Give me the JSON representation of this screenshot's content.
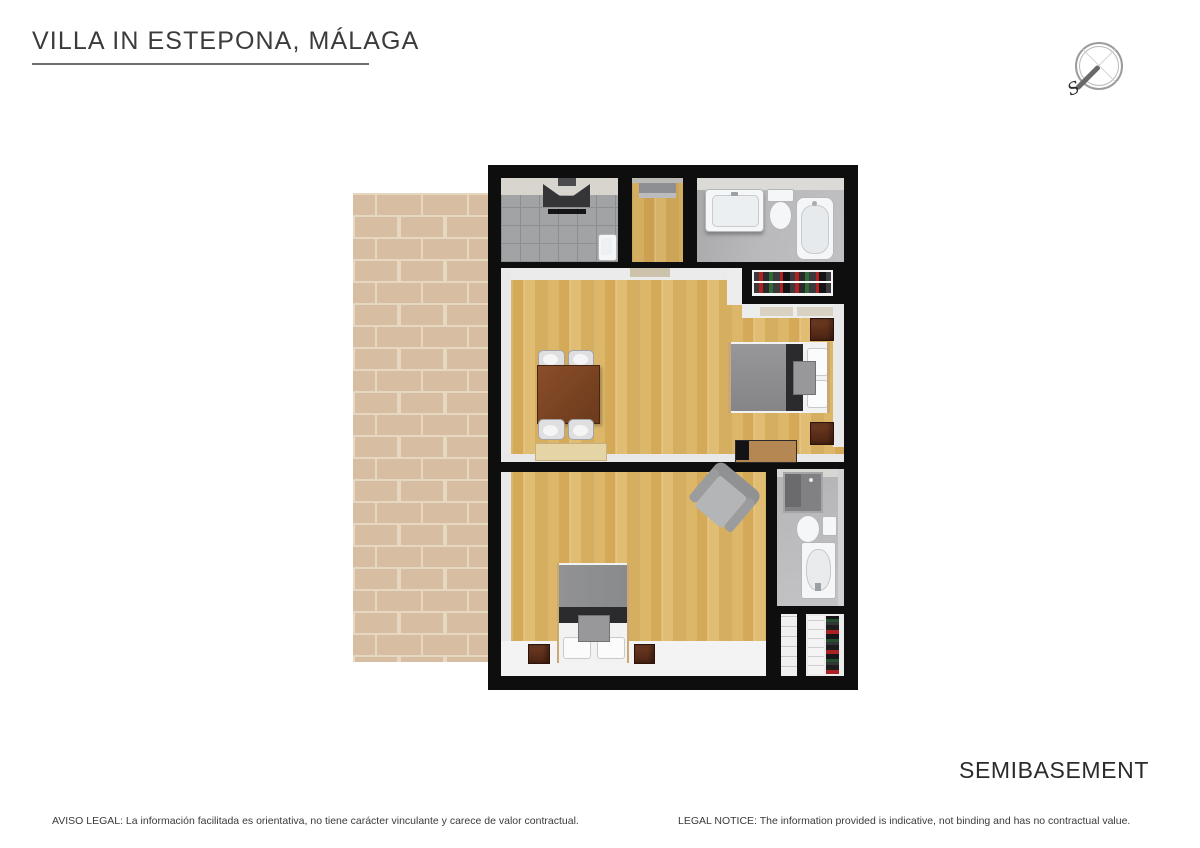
{
  "header": {
    "title": "VILLA IN ESTEPONA, MÁLAGA"
  },
  "compass": {
    "south_label": "S"
  },
  "floor_label": "SEMIBASEMENT",
  "footer": {
    "legal_es": "AVISO LEGAL: La información facilitada es orientativa, no tiene carácter vinculante y carece de valor contractual.",
    "legal_en": "LEGAL NOTICE: The information provided is indicative, not binding and has no contractual value."
  },
  "plan": {
    "rooms": [
      "terrace",
      "utility-room",
      "hallway",
      "bathroom",
      "wardrobe",
      "living-dining-room",
      "bedroom-1",
      "bedroom-2",
      "en-suite-bathroom",
      "closet"
    ],
    "palette": {
      "wall": "#0e0e0f",
      "wood_floor": "#d8b265",
      "terrace_brick": "#d9c0a6",
      "brick_mortar": "#eaddc9",
      "tile_floor": "#a2a3a5",
      "bathroom_floor": "#b7b7b9",
      "interior_wall_white": "#ebebec",
      "duvet_gray": "#8e8e90",
      "bed_runner_dark": "#2b2b2d",
      "nightstand_brown": "#5e2f1b",
      "dining_table_brown": "#7c4525",
      "sideboard_tan": "#e5d4a6"
    }
  }
}
